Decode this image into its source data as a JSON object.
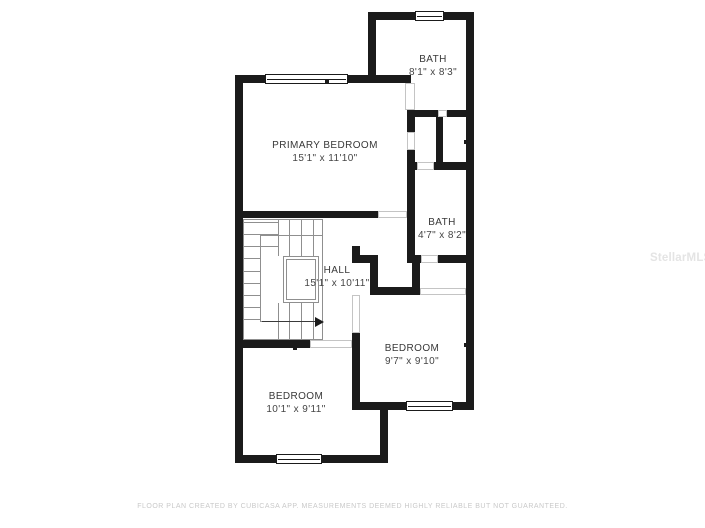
{
  "plan": {
    "rooms": [
      {
        "name": "BATH",
        "dims": "8'1\" x 8'3\""
      },
      {
        "name": "PRIMARY BEDROOM",
        "dims": "15'1\" x 11'10\""
      },
      {
        "name": "BATH",
        "dims": "4'7\" x 8'2\""
      },
      {
        "name": "HALL",
        "dims": "15'1\" x 10'11\""
      },
      {
        "name": "BEDROOM",
        "dims": "9'7\" x 9'10\""
      },
      {
        "name": "BEDROOM",
        "dims": "10'1\" x 9'11\""
      }
    ],
    "footer": "FLOOR PLAN CREATED BY CUBICASA APP. MEASUREMENTS DEEMED HIGHLY RELIABLE BUT NOT GUARANTEED.",
    "watermark": "StellarMLS",
    "colors": {
      "wall": "#1b1b1b",
      "stair_line": "#8f8f8f",
      "label": "#383838",
      "door_line": "#c4c4c4",
      "footer": "#c9c9c9",
      "watermark": "#e4e4e4"
    }
  }
}
